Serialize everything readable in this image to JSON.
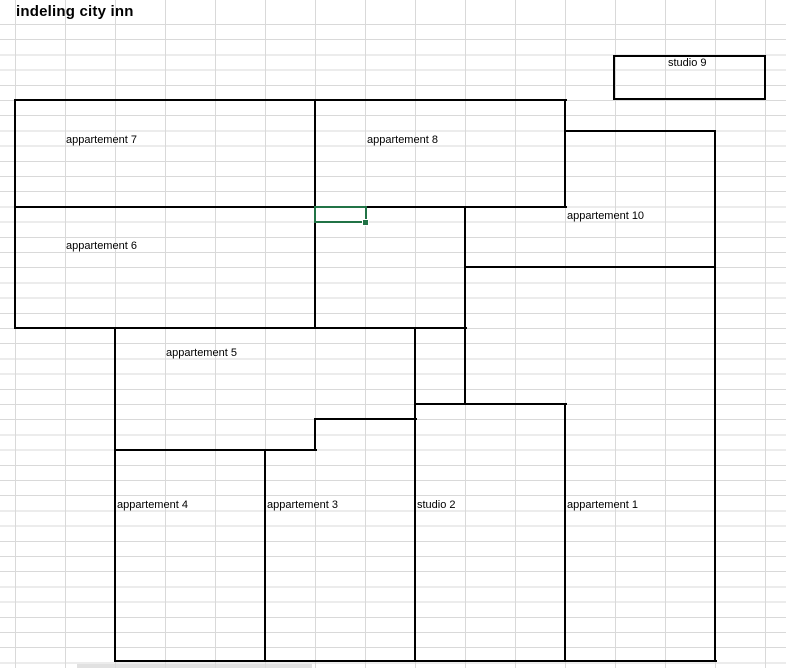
{
  "title": "indeling city inn",
  "rooms": [
    {
      "label": "studio 9"
    },
    {
      "label": "appartement 7"
    },
    {
      "label": "appartement 8"
    },
    {
      "label": "appartement 10"
    },
    {
      "label": "appartement 6"
    },
    {
      "label": "appartement 5"
    },
    {
      "label": "appartement 4"
    },
    {
      "label": "appartement 3"
    },
    {
      "label": "studio 2"
    },
    {
      "label": "appartement 1"
    }
  ],
  "colors": {
    "selection_green": "#217346",
    "gridline": "#d9d9d9",
    "wall_border": "#000000",
    "background": "#ffffff"
  }
}
